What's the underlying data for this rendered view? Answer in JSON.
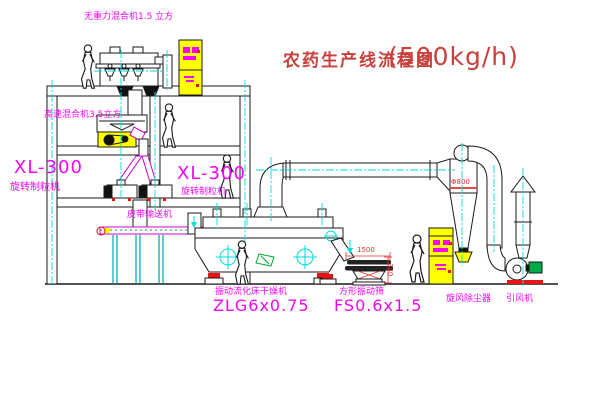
{
  "title": {
    "text": "农药生产线流程图",
    "capacity": "(500kg/h)"
  },
  "equipment_labels": {
    "gravity_mixer": "无重力混合机1.5 立方",
    "high_speed_mixer": "高速混合机3.5立方",
    "granulator_left_model": "XL-300",
    "granulator_left_name": "旋转制粒机",
    "granulator_right_model": "XL-300",
    "granulator_right_name": "旋转制粒机",
    "belt_conveyor": "皮带输送机",
    "fluid_bed_dryer_name": "振动流化床干燥机",
    "fluid_bed_dryer_model": "ZLG6x0.75",
    "vibrating_screen_name": "方形振动筛",
    "vibrating_screen_model": "FS0.6x1.5",
    "cyclone_name": "旋风除尘器",
    "fan_name": "引风机"
  },
  "dimensions": {
    "screen_length": "1500",
    "screen_height": "340",
    "cyclone_diameter": "Φ800"
  },
  "colors": {
    "label_magenta": "#f505f5",
    "title_red": "#c8403c",
    "line_black": "#1a1a1a",
    "accent_yellow": "#ffff00",
    "accent_cyan": "#00dddd",
    "accent_red": "#ee1111",
    "accent_green": "#00aa33"
  }
}
